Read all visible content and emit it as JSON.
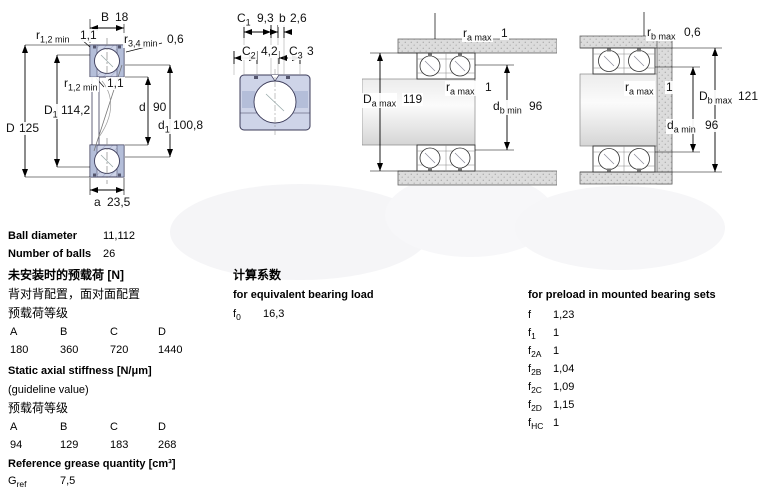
{
  "diagrams": {
    "front_view": {
      "dims": {
        "B": {
          "n": "B",
          "s": "",
          "v": "18"
        },
        "r12_top": {
          "n": "r",
          "s": "1,2 min",
          "v": "1,1"
        },
        "r34": {
          "n": "r",
          "s": "3,4 min",
          "v": "0,6"
        },
        "r12_inner": {
          "n": "r",
          "s": "1,2 min",
          "v": "1,1"
        },
        "D1": {
          "n": "D",
          "s": "1",
          "v": "114,2"
        },
        "d": {
          "n": "d",
          "s": "",
          "v": "90"
        },
        "d1": {
          "n": "d",
          "s": "1",
          "v": "100,8"
        },
        "D": {
          "n": "D",
          "s": "",
          "v": "125"
        },
        "a": {
          "n": "a",
          "s": "",
          "v": "23,5"
        }
      }
    },
    "face_view": {
      "dims": {
        "C1": {
          "n": "C",
          "s": "1",
          "v": "9,3"
        },
        "b": {
          "n": "b",
          "s": "",
          "v": "2,6"
        },
        "C2": {
          "n": "C",
          "s": "2",
          "v": "4,2"
        },
        "C3": {
          "n": "C",
          "s": "3",
          "v": "3"
        }
      }
    },
    "housing_fit": {
      "dims": {
        "ra_top": {
          "n": "r",
          "s": "a max",
          "v": "1"
        },
        "ra_mid": {
          "n": "r",
          "s": "a max",
          "v": "1"
        },
        "Da": {
          "n": "D",
          "s": "a max",
          "v": "119"
        },
        "db": {
          "n": "d",
          "s": "b min",
          "v": "96"
        }
      }
    },
    "shaft_fit": {
      "dims": {
        "rb": {
          "n": "r",
          "s": "b max",
          "v": "0,6"
        },
        "ra": {
          "n": "r",
          "s": "a max",
          "v": "1"
        },
        "Db": {
          "n": "D",
          "s": "b max",
          "v": "121"
        },
        "da": {
          "n": "d",
          "s": "a min",
          "v": "96"
        }
      }
    }
  },
  "specs": {
    "ball_diameter": {
      "label": "Ball diameter",
      "value": "11,112"
    },
    "number_of_balls": {
      "label": "Number of balls",
      "value": "26"
    },
    "preload_unmounted": {
      "heading": "未安装时的预载荷 [N]",
      "line1": "背对背配置，面对面配置",
      "line2": "预载荷等级",
      "classes": [
        "A",
        "B",
        "C",
        "D"
      ],
      "values": [
        "180",
        "360",
        "720",
        "1440"
      ]
    },
    "static_axial_stiffness": {
      "heading": "Static axial stiffness [N/μm]",
      "note": "(guideline value)",
      "line": "预载荷等级",
      "classes": [
        "A",
        "B",
        "C",
        "D"
      ],
      "values": [
        "94",
        "129",
        "183",
        "268"
      ]
    },
    "grease": {
      "heading": "Reference grease quantity [cm³]",
      "row": {
        "n": "G",
        "s": "ref",
        "v": "7,5"
      }
    },
    "calculation_factors": {
      "heading_cn": "计算系数",
      "equivalent_heading": "for equivalent bearing load",
      "f0": {
        "n": "f",
        "s": "0",
        "v": "16,3"
      },
      "preload_heading": "for preload in mounted bearing sets",
      "rows": [
        {
          "n": "f",
          "s": "",
          "v": "1,23"
        },
        {
          "n": "f",
          "s": "1",
          "v": "1"
        },
        {
          "n": "f",
          "s": "2A",
          "v": "1"
        },
        {
          "n": "f",
          "s": "2B",
          "v": "1,04"
        },
        {
          "n": "f",
          "s": "2C",
          "v": "1,09"
        },
        {
          "n": "f",
          "s": "2D",
          "v": "1,15"
        },
        {
          "n": "f",
          "s": "HC",
          "v": "1"
        }
      ]
    }
  },
  "colors": {
    "ring_fill": "#ced4e8",
    "ring_dark": "#b4bed9",
    "outline": "#3c3c5a",
    "housing_gray": "#dcdcdc"
  }
}
